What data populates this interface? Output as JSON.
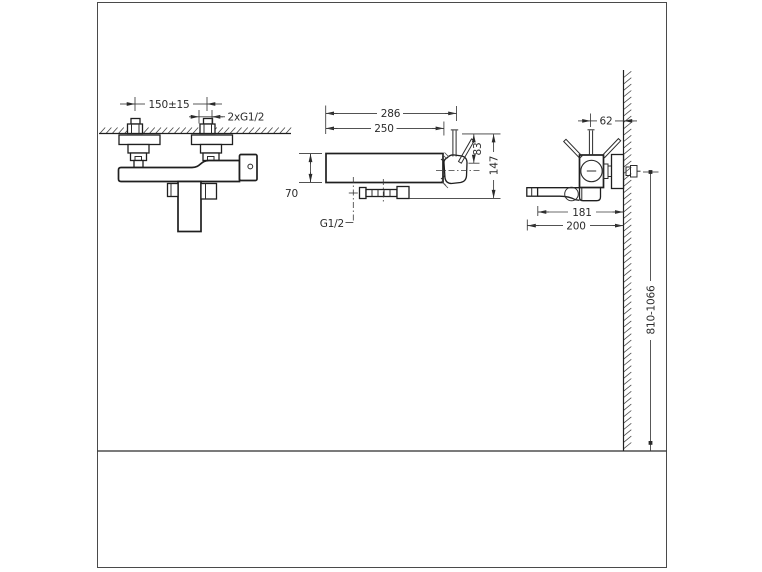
{
  "drawing": {
    "background": "#ffffff",
    "line_color": "#1f1f1f",
    "views": {
      "front_view": {
        "hole_spacing": "150±15",
        "supply_connections": "2xG1/2"
      },
      "top_view": {
        "overall_width": "286",
        "body_width": "250",
        "body_depth": "70",
        "lever_height": "83",
        "overall_depth": "147",
        "outlet_thread": "G1/2"
      },
      "side_view": {
        "lever_axis_to_wall": "62",
        "spout_projection": "181",
        "overall_projection": "200",
        "installation_height": "810-1066"
      }
    }
  }
}
